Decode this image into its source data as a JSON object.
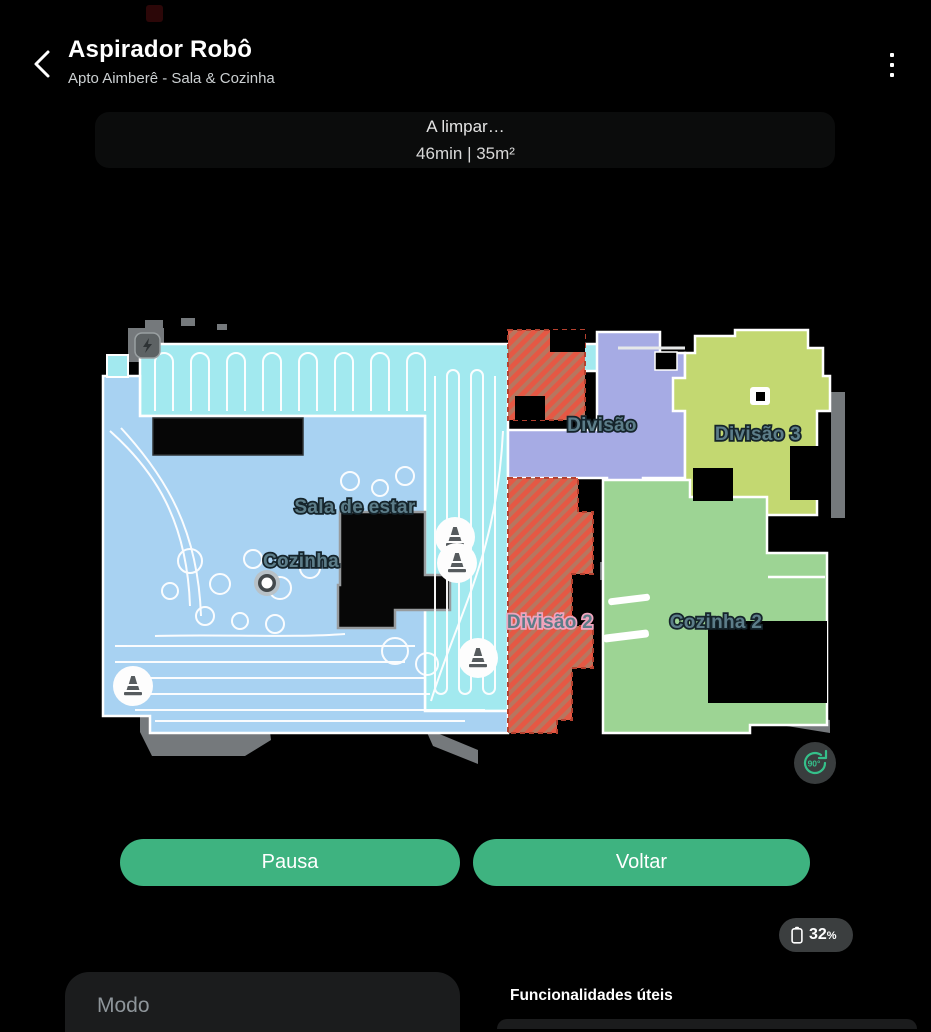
{
  "header": {
    "title": "Aspirador Robô",
    "subtitle": "Apto Aimberê - Sala & Cozinha",
    "back_icon": "chevron-left",
    "menu_icon": "kebab-vertical"
  },
  "status": {
    "line1": "A limpar…",
    "line2": "46min | 35m²",
    "time": "46min",
    "area": "35m²"
  },
  "map": {
    "rooms": [
      {
        "name": "Sala de estar",
        "color": "#a2e9ef"
      },
      {
        "name": "Cozinha",
        "color": "#a8d2f2"
      },
      {
        "name": "Divisão",
        "color": "#a6abe4"
      },
      {
        "name": "Divisão 3",
        "color": "#c3d871"
      },
      {
        "name": "Divisão 2",
        "color": "#e55844",
        "type": "no-go-zone"
      },
      {
        "name": "Cozinha 2",
        "color": "#9dd494"
      }
    ],
    "labels": [
      {
        "text": "Sala de estar"
      },
      {
        "text": "Cozinha"
      },
      {
        "text": "Divisão"
      },
      {
        "text": "Divisão 3"
      },
      {
        "text": "Divisão 2"
      },
      {
        "text": "Cozinha 2"
      }
    ],
    "no_go_stripe_color": "#a88068",
    "no_go_border_color": "#b5412f",
    "cone_count": 4,
    "rotate_button_label": "90°",
    "rotate_accent": "#35c08a"
  },
  "actions": {
    "pause_label": "Pausa",
    "return_label": "Voltar"
  },
  "battery": {
    "level": "32",
    "percent_sign": "%",
    "icon": "battery-outline"
  },
  "bottom": {
    "mode_card_label": "Modo",
    "features_title": "Funcionalidades úteis"
  },
  "colors": {
    "background": "#000000",
    "accent_button": "#3eb380",
    "badge_background": "#3b3e3f",
    "card_background": "#1b1c1d",
    "map_label": "#5c7d89",
    "map_label_outline_pink": "#f0a4be"
  }
}
